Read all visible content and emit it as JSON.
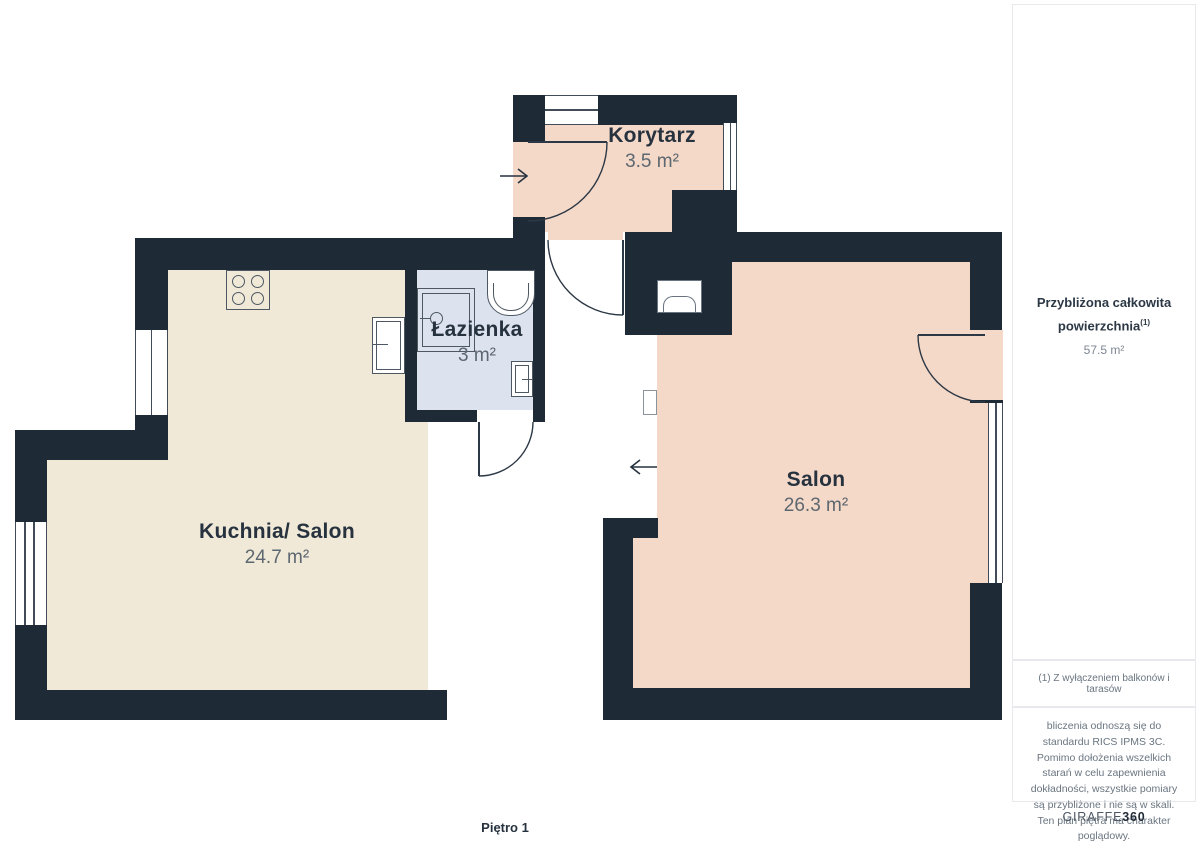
{
  "colors": {
    "wall": "#1e2a36",
    "kitchen_fill": "#f0e9d7",
    "living_fill": "#f4d8c8",
    "bath_fill": "#dde3ee",
    "label": "#27323f",
    "muted": "#5d6770",
    "sidebar_border": "#e7e9ec",
    "sidebar_text": "#2c3845"
  },
  "rooms": [
    {
      "id": "korytarz",
      "name": "Korytarz",
      "area": "3.5 m²"
    },
    {
      "id": "lazienka",
      "name": "Łazienka",
      "area": "3 m²"
    },
    {
      "id": "kuchnia-salon",
      "name": "Kuchnia/ Salon",
      "area": "24.7 m²"
    },
    {
      "id": "salon",
      "name": "Salon",
      "area": "26.3 m²"
    }
  ],
  "floor": {
    "label": "Piętro 1"
  },
  "sidebar": {
    "total_title_line1": "Przybliżona całkowita",
    "total_title_line2": "powierzchnia",
    "total_footnote_marker": "(1)",
    "total_value": "57.5 m²",
    "footnote": "(1) Z wyłączeniem balkonów i tarasów",
    "disclaimer": "bliczenia odnoszą się do standardu RICS IPMS 3C. Pomimo dołożenia wszelkich starań w celu zapewnienia dokładności, wszystkie pomiary są przybliżone i nie są w skali. Ten plan piętra ma charakter poglądowy.",
    "logo": {
      "brand": "GIRAFFE",
      "suffix": "360"
    }
  },
  "icons": {
    "entrance_arrow": "→",
    "salon_entrance_arrow": "←"
  }
}
